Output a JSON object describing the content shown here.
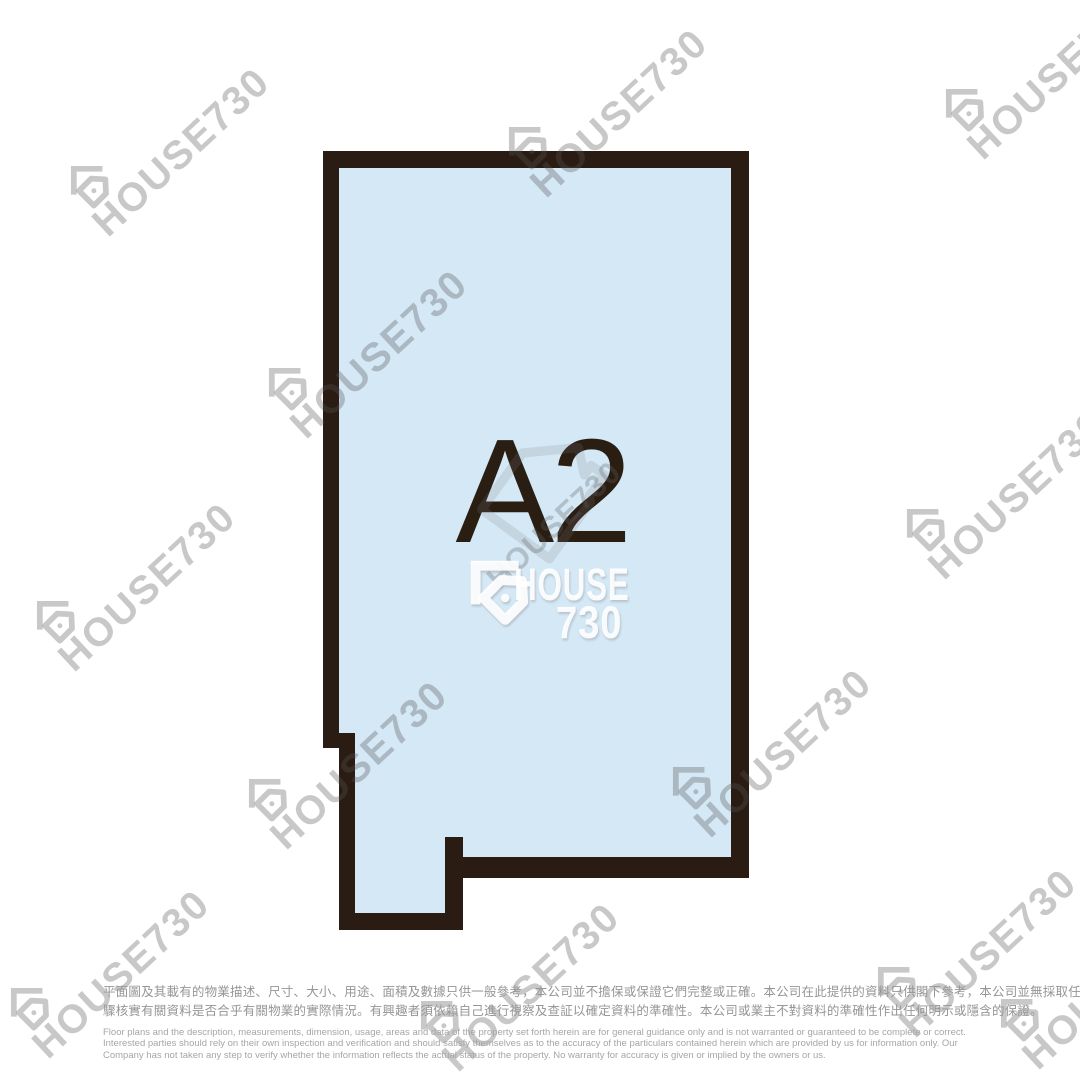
{
  "floor_plan": {
    "unit_label": "A2"
  },
  "watermark": {
    "diagonal_text": "HOUSE730",
    "center_brand_top": "HOUSE",
    "center_brand_bottom": "730"
  },
  "disclaimer": {
    "zh_lines": [
      "平面圖及其載有的物業描述、尺寸、大小、用途、面積及數據只供一般參考，本公司並不擔保或保證它們完整或正確。本公司在此提供的資料只供閣下參考，本公司並無採取任何步",
      "驟核實有關資料是否合乎有關物業的實際情況。有興趣者須依賴自己進行視察及查証以確定資料的準確性。本公司或業主不對資料的準確性作出任何明示或隱含的保證。"
    ],
    "en_lines": [
      "Floor plans and the description, measurements, dimension, usage, areas and data of the property set forth herein are for general guidance only and is not warranted or guaranteed to be complete or correct.",
      "Interested parties should rely on their own inspection and verification and should satisfy themselves as to the accuracy of the particulars contained herein which are provided by us for information only.  Our",
      "Company has not taken any step to verify whether the information reflects the actual status of the property.  No warranty for accuracy is given or implied by the owners or us."
    ]
  },
  "colors": {
    "wall": "#2a1c12",
    "floor_fill": "#d4e8f6",
    "unit_label_color": "#2a1e13",
    "watermark_gray": "rgba(85,85,85,0.32)",
    "disclaimer_zh": "#969696",
    "disclaimer_en": "#a6a6a6"
  }
}
